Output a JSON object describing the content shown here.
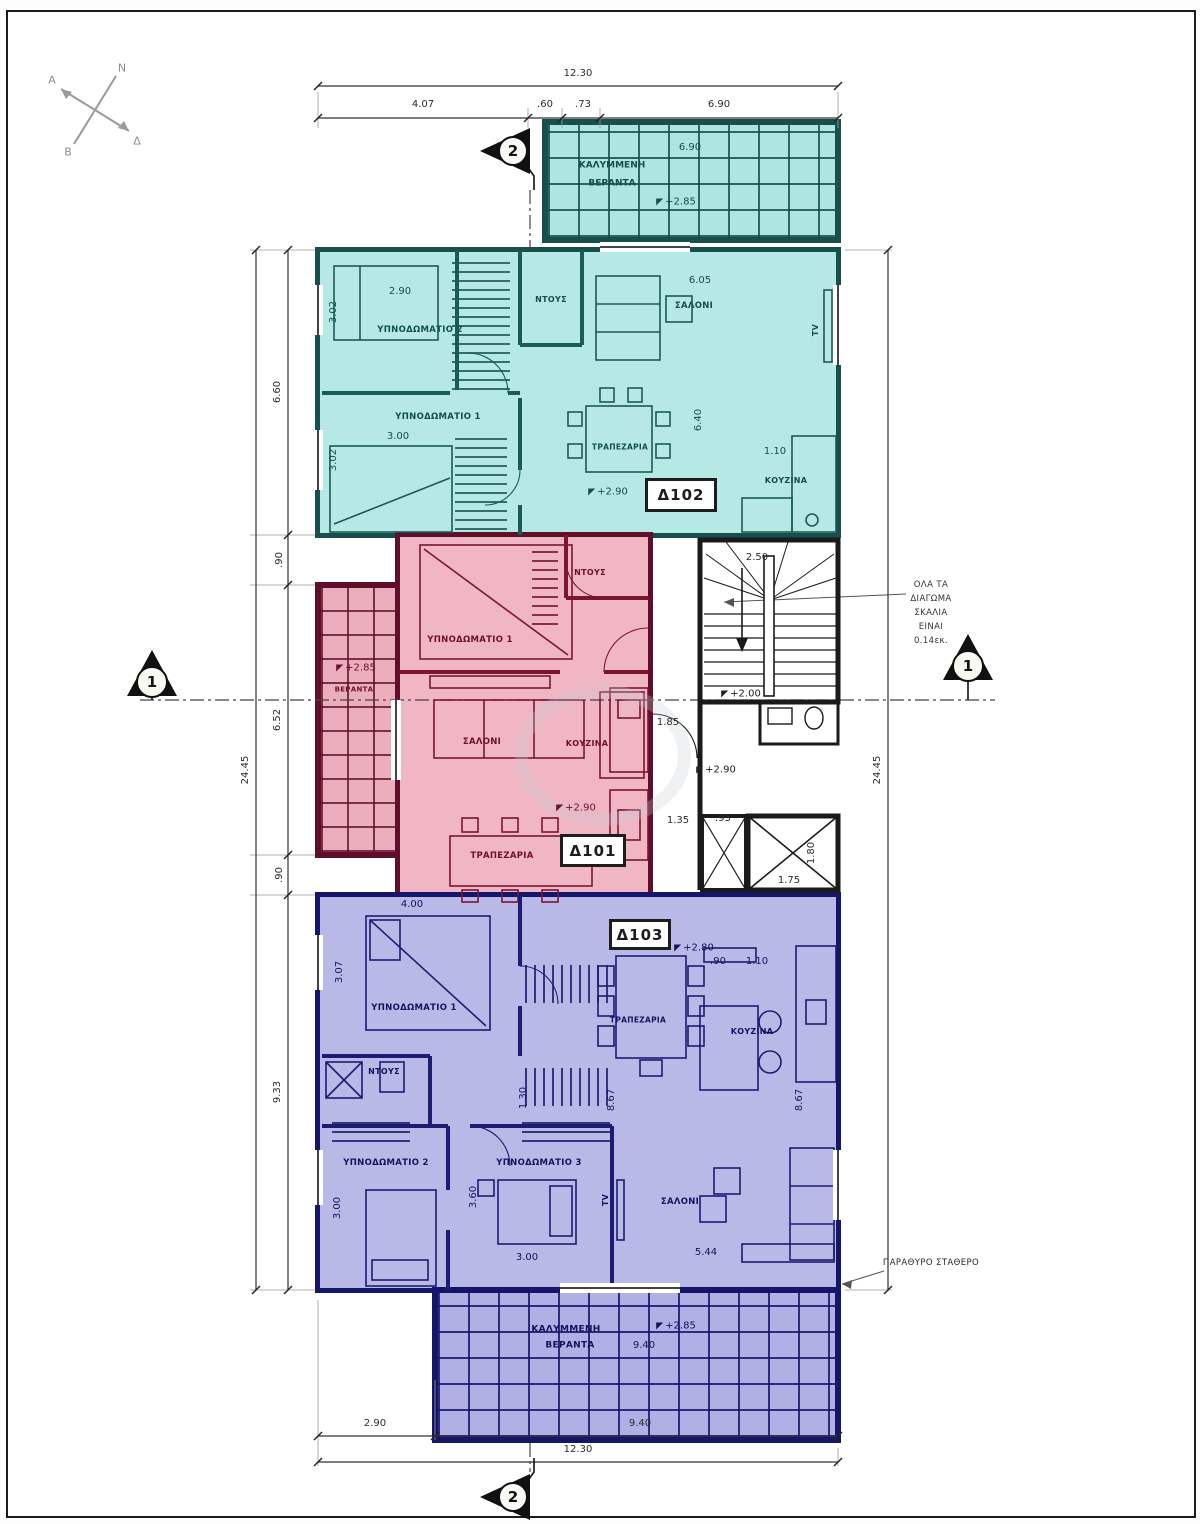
{
  "compass": {
    "n": "Ν",
    "e": "Δ",
    "s": "Β",
    "w": "Α"
  },
  "section_markers": {
    "one": "1",
    "two": "2"
  },
  "dims": {
    "top": {
      "total": "12.30",
      "a": "4.07",
      "b": ".60",
      "c": ".73",
      "d": "6.90"
    },
    "left": {
      "total": "24.45",
      "a": "6.60",
      "b": ".90",
      "c": "6.52",
      "d": ".90",
      "e": "9.33"
    },
    "right": {
      "total": "24.45"
    },
    "bottom": {
      "total": "12.30",
      "a": "2.90",
      "b": "9.40"
    }
  },
  "apartments": {
    "d102": {
      "id": "Δ102",
      "level": "+2.90",
      "rooms": {
        "bedroom2": "ΥΠΝΟΔΩΜΑΤΙΟ 2",
        "bedroom1": "ΥΠΝΟΔΩΜΑΤΙΟ 1",
        "shower": "ΝΤΟΥΣ",
        "living": "ΣΑΛΟΝΙ",
        "dining": "ΤΡΑΠΕΖΑΡΙΑ",
        "kitchen": "ΚΟΥΖΙΝΑ",
        "tv": "TV"
      },
      "dims": {
        "bedroom2_w": "2.90",
        "bedroom2_d": "3.02",
        "bedroom1_w": "3.00",
        "bedroom1_d": "3.02",
        "living_w": "6.05",
        "living_d": "6.40",
        "kitchen_w": "1.10"
      },
      "balcony": {
        "name1": "ΚΑΛΥΜΜΕΝΗ",
        "name2": "ΒΕΡΑΝΤΑ",
        "level": "+2.85",
        "width": "6.90"
      }
    },
    "d101": {
      "id": "Δ101",
      "level": "+2.90",
      "rooms": {
        "bedroom1": "ΥΠΝΟΔΩΜΑΤΙΟ 1",
        "shower": "ΝΤΟΥΣ",
        "living": "ΣΑΛΟΝΙ",
        "kitchen": "ΚΟΥΖΙΝΑ",
        "dining": "ΤΡΑΠΕΖΑΡΙΑ"
      },
      "balcony": {
        "name": "ΒΕΡΑΝΤΑ",
        "level": "+2.85"
      }
    },
    "d103": {
      "id": "Δ103",
      "level": "+2.80",
      "rooms": {
        "bedroom1": "ΥΠΝΟΔΩΜΑΤΙΟ 1",
        "bedroom2": "ΥΠΝΟΔΩΜΑΤΙΟ 2",
        "bedroom3": "ΥΠΝΟΔΩΜΑΤΙΟ 3",
        "shower": "ΝΤΟΥΣ",
        "living": "ΣΑΛΟΝΙ",
        "kitchen": "ΚΟΥΖΙΝΑ",
        "dining": "ΤΡΑΠΕΖΑΡΙΑ",
        "tv": "TV"
      },
      "dims": {
        "bedroom1_w": "4.00",
        "bedroom1_d": "3.07",
        "hall_d": "1.30",
        "kitchen_a": ".90",
        "kitchen_b": "1.10",
        "depth_left": "8.67",
        "depth_right": "8.67",
        "bedroom2_d": "3.00",
        "bedroom3_d": "3.60",
        "bedroom3_w": "3.00",
        "living_w": "5.44"
      },
      "balcony": {
        "name1": "ΚΑΛΥΜΜΕΝΗ",
        "name2": "ΒΕΡΑΝΤΑ",
        "level": "+2.85",
        "width": "9.40"
      }
    }
  },
  "core": {
    "stair_width": "2.50",
    "half_landing_level": "+2.00",
    "landing_level": "+2.90",
    "hall_a": "1.85",
    "hall_b": "1.35",
    "hall_c": ".95",
    "lift_w": "1.75",
    "lift_d": "1.80",
    "note_lines": [
      "ΟΛΑ ΤΑ",
      "ΔΙΑΓΩΜΑ",
      "ΣΚΑΛΙΑ",
      "ΕΙΝΑΙ",
      "0.14εκ."
    ]
  },
  "notes": {
    "fixed_window": "ΠΑΡΑΘΥΡΟ ΣΤΑΘΕΡΟ"
  },
  "colors": {
    "apt102_fill": "#b6e9e6",
    "apt102_line": "#1a5a57",
    "apt101_fill": "#f0b6c4",
    "apt101_line": "#7a1535",
    "apt103_fill": "#b9b9e8",
    "apt103_line": "#1c1c72",
    "walls": "#1a1a1a"
  }
}
